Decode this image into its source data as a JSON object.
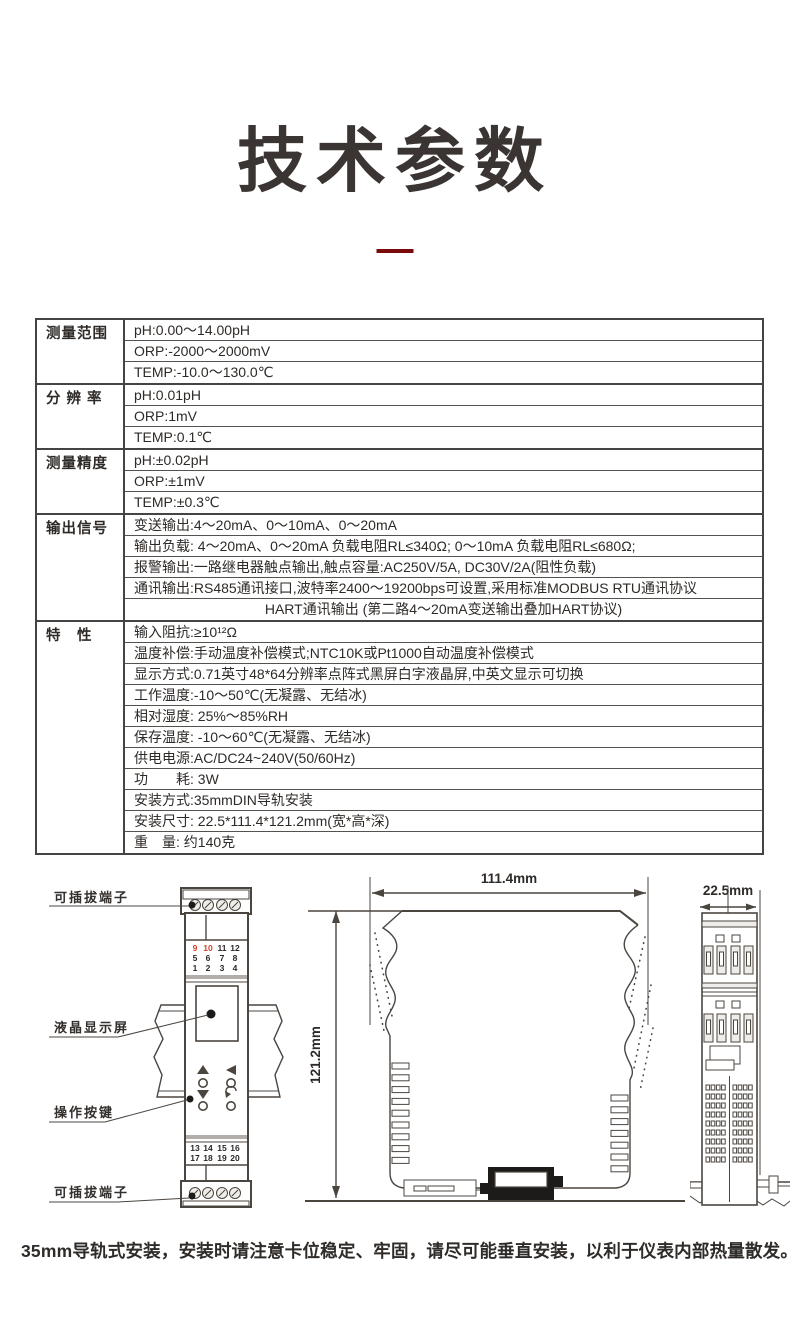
{
  "page": {
    "title": "技术参数"
  },
  "caption": "35mm导轨式安装，安装时请注意卡位稳定、牢固，请尽可能垂直安装，以利于仪表内部热量散发。",
  "colors": {
    "accent_red": "#7a0a0a",
    "terminal_red": "#d0402e",
    "ink": "#2e2a27",
    "line": "#4b453f"
  },
  "spec_table": {
    "groups": [
      {
        "label": "测量范围",
        "rows": [
          {
            "text": "pH:0.00～14.00pH"
          },
          {
            "text": "ORP:-2000～2000mV"
          },
          {
            "text": "TEMP:-10.0～130.0℃"
          }
        ]
      },
      {
        "label": "分 辨 率",
        "rows": [
          {
            "text": "pH:0.01pH"
          },
          {
            "text": "ORP:1mV"
          },
          {
            "text": "TEMP:0.1℃"
          }
        ]
      },
      {
        "label": "测量精度",
        "rows": [
          {
            "text": "pH:±0.02pH"
          },
          {
            "text": "ORP:±1mV"
          },
          {
            "text": "TEMP:±0.3℃"
          }
        ]
      },
      {
        "label": "输出信号",
        "rows": [
          {
            "text": "变送输出:4～20mA、0～10mA、0～20mA"
          },
          {
            "text": "输出负载: 4～20mA、0～20mA 负载电阻RL≤340Ω; 0～10mA 负载电阻RL≤680Ω;"
          },
          {
            "text": "报警输出:一路继电器触点输出,触点容量:AC250V/5A, DC30V/2A(阻性负载)"
          },
          {
            "text": "通讯输出:RS485通讯接口,波特率2400～19200bps可设置,采用标准MODBUS RTU通讯协议"
          },
          {
            "text": "HART通讯输出 (第二路4～20mA变送输出叠加HART协议)",
            "center": true
          }
        ]
      },
      {
        "label": "特　性",
        "rows": [
          {
            "text": "输入阻抗:≥10¹²Ω"
          },
          {
            "text": "温度补偿:手动温度补偿模式;NTC10K或Pt1000自动温度补偿模式"
          },
          {
            "text": "显示方式:0.71英寸48*64分辨率点阵式黑屏白字液晶屏,中英文显示可切换"
          },
          {
            "text": "工作温度:-10～50℃(无凝露、无结冰)"
          },
          {
            "text": "相对湿度: 25%～85%RH"
          },
          {
            "text": "保存温度: -10～60℃(无凝露、无结冰)"
          },
          {
            "text": "供电电源:AC/DC24~240V(50/60Hz)"
          },
          {
            "text": "功　　耗: 3W"
          },
          {
            "text": "安装方式:35mmDIN导轨安装"
          },
          {
            "text": "安装尺寸: 22.5*111.4*121.2mm(宽*高*深)"
          },
          {
            "text": "重　量: 约140克"
          }
        ]
      }
    ]
  },
  "front_view": {
    "labels": {
      "top_terminal": "可插拔端子",
      "display": "液晶显示屏",
      "buttons": "操作按键",
      "bottom_terminal": "可插拔端子"
    },
    "terminals_top": {
      "rows": [
        [
          "9",
          "10",
          "11",
          "12"
        ],
        [
          "5",
          "6",
          "7",
          "8"
        ],
        [
          "1",
          "2",
          "3",
          "4"
        ]
      ],
      "red": [
        "9",
        "10"
      ]
    },
    "terminals_bottom": {
      "rows": [
        [
          "13",
          "14",
          "15",
          "16"
        ],
        [
          "17",
          "18",
          "19",
          "20"
        ]
      ],
      "red": []
    }
  },
  "dimensions": {
    "width": "111.4mm",
    "height": "121.2mm",
    "depth": "22.5mm"
  }
}
